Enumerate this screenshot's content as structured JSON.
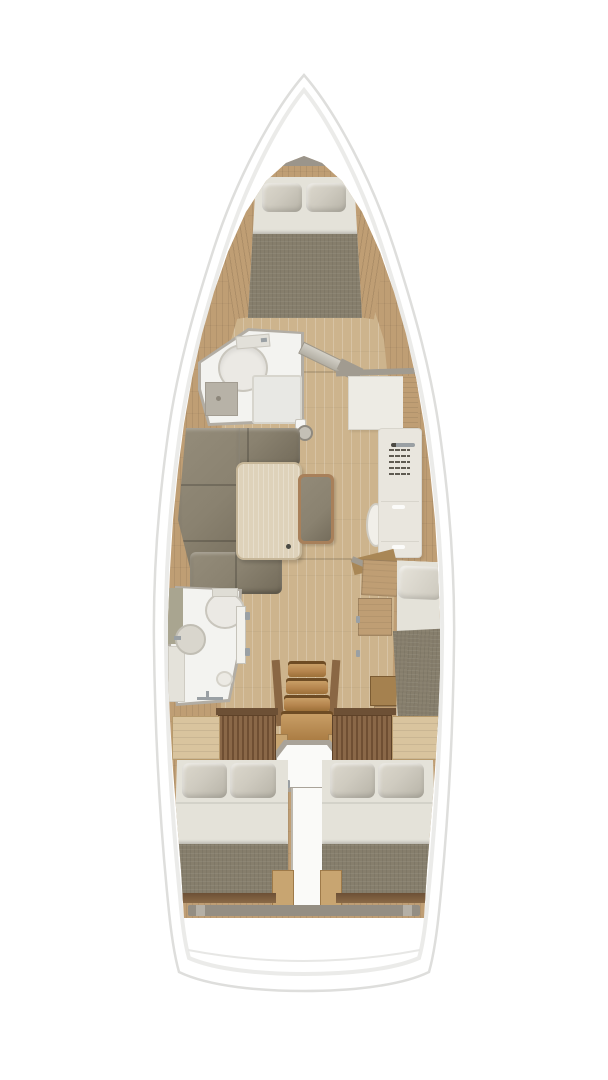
{
  "meta": {
    "type": "sailing-yacht-interior-floorplan",
    "view": "top-down",
    "orientation": "bow-up",
    "visible_text": "none"
  },
  "palette": {
    "background": "#ffffff",
    "hull": "#ffffff",
    "hull_outline": "#dededc",
    "deck_line": "#ebebe9",
    "side_wood": "#bf9e74",
    "floor": "#cdb48d",
    "trim_dark": "#6d5035",
    "stair_wood": "#b5854e",
    "wardrobe_wood": "#8a6848",
    "wardrobe_stripe": "#6f4f33",
    "shelf_wood": "#d9c49e",
    "cushion": "#8a8270",
    "blanket": "#867e6c",
    "pillow": "#cfcbc0",
    "pillow_shade": "#b7b3a7",
    "sheet": "#e4e2d9",
    "bath_floor": "#f3f3f0",
    "bath_wall": "#b2ada4",
    "fixture": "#ebe9e4",
    "fixture_line": "#c9c6bd",
    "bulkhead": "#a19b90",
    "table_wood": "#ded2ba",
    "table_border": "#c6b698",
    "bench_wood": "#a8805a",
    "counter": "#e9e6de",
    "grille": "#5f5b52",
    "steel": "#9aa0a4",
    "locker_gray": "#9b958b",
    "white_box": "#fafaf8"
  },
  "areas": {
    "bow_cabin": {
      "name": "v-berth-double-cabin",
      "furniture": [
        "bow-locker",
        "double-berth",
        "pillows",
        "blanket",
        "side-trims"
      ]
    },
    "forward_head": {
      "name": "forward-head",
      "furniture": [
        "round-toilet",
        "cistern",
        "shower-tray",
        "vanity-sink",
        "open-door",
        "floor-hatch"
      ]
    },
    "salon": {
      "name": "salon",
      "furniture": [
        "u-shaped-sofa",
        "dining-table",
        "bench-seat"
      ]
    },
    "galley_nav": {
      "name": "galley-and-nav",
      "furniture": [
        "nav-locker",
        "counter-unit",
        "vent-grille",
        "handle",
        "side-oval-seat",
        "step"
      ]
    },
    "mid_cabin_starboard": {
      "name": "starboard-mid-cabin",
      "furniture": [
        "single-berth",
        "lockers",
        "nightstand"
      ]
    },
    "aft_head": {
      "name": "aft-head",
      "furniture": [
        "oval-toilet",
        "round-sink",
        "shower-drain",
        "shower-mixer",
        "door",
        "shelves"
      ]
    },
    "companionway": {
      "name": "companionway",
      "furniture": [
        "stairs-4-treads",
        "landing",
        "engine-box",
        "wardrobe-panels",
        "shelves"
      ]
    },
    "aft_cabin_port": {
      "name": "port-aft-double-cabin",
      "furniture": [
        "double-berth",
        "pillows",
        "blanket"
      ]
    },
    "aft_cabin_starboard": {
      "name": "starboard-aft-double-cabin",
      "furniture": [
        "double-berth",
        "pillows",
        "blanket"
      ]
    },
    "stern": {
      "name": "transom-deck",
      "furniture": [
        "cockpit-step-band"
      ]
    }
  }
}
